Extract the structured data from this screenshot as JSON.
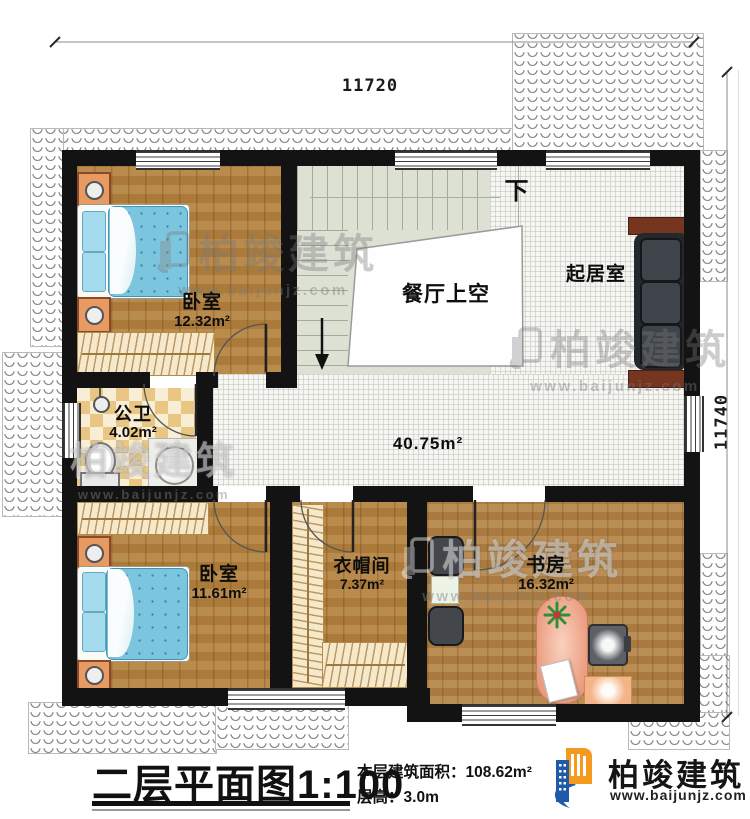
{
  "dimensions": {
    "top": "11720",
    "right": "11740"
  },
  "rooms": {
    "bedroom1": {
      "name": "卧室",
      "area": "12.32m²"
    },
    "dining_void": {
      "name": "餐厅上空"
    },
    "living": {
      "name": "起居室"
    },
    "bathroom": {
      "name": "公卫",
      "area": "4.02m²"
    },
    "hall": {
      "area": "40.75m²"
    },
    "bedroom2": {
      "name": "卧室",
      "area": "11.61m²"
    },
    "cloakroom": {
      "name": "衣帽间",
      "area": "7.37m²"
    },
    "study": {
      "name": "书房",
      "area": "16.32m²"
    }
  },
  "stairs": {
    "down": "下"
  },
  "watermark": {
    "brand": "柏竣建筑",
    "url": "www.baijunjz.com"
  },
  "title_block": {
    "title": "二层平面图",
    "scale": "1:100",
    "area_label": "本层建筑面积：",
    "area_value": "108.62m²",
    "floor_height_label": "层高：",
    "floor_height_value": "3.0m"
  },
  "logo": {
    "brand": "柏竣建筑",
    "url": "www.baijunjz.com"
  },
  "colors": {
    "wall": "#131313",
    "accent_blue": "#1e5aa7",
    "accent_orange": "#f59a1e",
    "quilt": "#7cc5de"
  }
}
